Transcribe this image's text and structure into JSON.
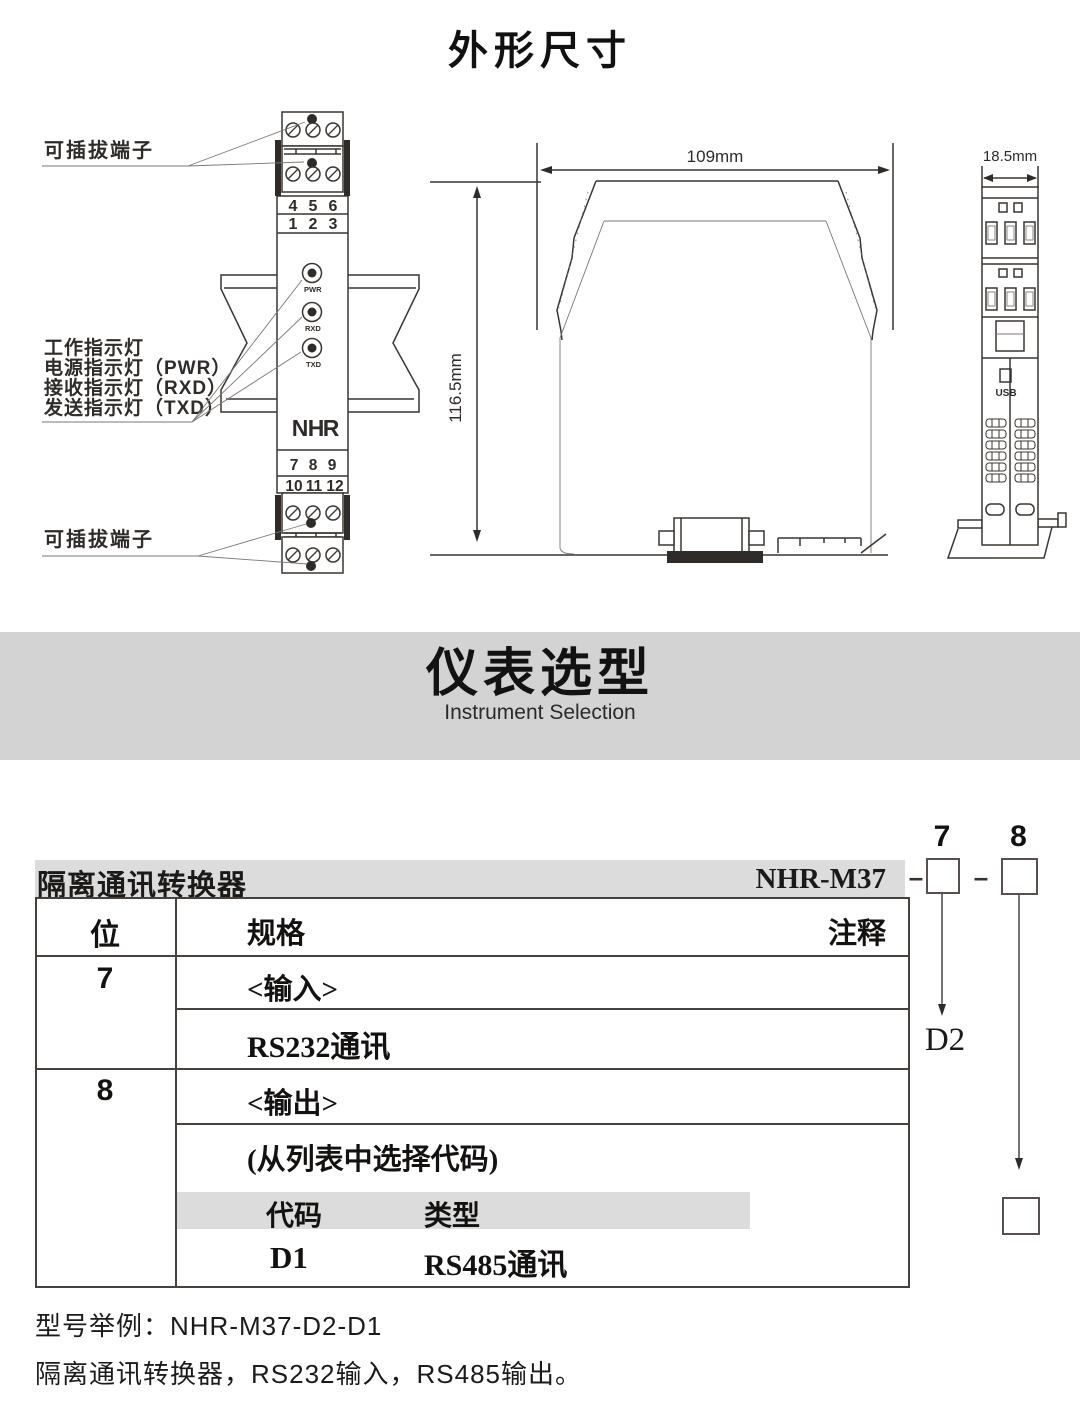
{
  "outline": {
    "title": "外形尺寸"
  },
  "front_view": {
    "pluggable_top": "可插拔端子",
    "pluggable_bottom": "可插拔端子",
    "indicators": [
      "工作指示灯",
      "电源指示灯（PWR）",
      "接收指示灯（RXD）",
      "发送指示灯（TXD）"
    ],
    "top_row1": [
      "4",
      "5",
      "6"
    ],
    "top_row2": [
      "1",
      "2",
      "3"
    ],
    "bottom_row1": [
      "7",
      "8",
      "9"
    ],
    "bottom_row2": [
      "10",
      "11",
      "12"
    ],
    "leds": [
      "PWR",
      "RXD",
      "TXD"
    ],
    "logo": [
      "N",
      "H",
      "R"
    ]
  },
  "side_view": {
    "width": "109mm",
    "height": "116.5mm"
  },
  "profile_view": {
    "width": "18.5mm",
    "usb": "USB"
  },
  "banner": {
    "title": "仪表选型",
    "subtitle": "Instrument Selection"
  },
  "selection": {
    "product": "隔离通讯转换器",
    "model": "NHR-M37",
    "dash": "–",
    "digit7": "7",
    "digit8": "8",
    "col_position": "位",
    "col_spec": "规格",
    "col_note": "注释",
    "row7": {
      "pos": "7",
      "title": "<输入>",
      "value": "RS232通讯",
      "code": "D2"
    },
    "row8": {
      "pos": "8",
      "title": "<输出>",
      "note": "(从列表中选择代码)",
      "code_header": "代码",
      "type_header": "类型",
      "code": "D1",
      "type": "RS485通讯"
    },
    "example_line1": "型号举例：NHR-M37-D2-D1",
    "example_line2": "隔离通讯转换器，RS232输入，RS485输出。"
  },
  "colors": {
    "accent_red": "#c8161d",
    "banner_gray": "#d3d3d3",
    "bar_gray": "#dcdcdc"
  }
}
